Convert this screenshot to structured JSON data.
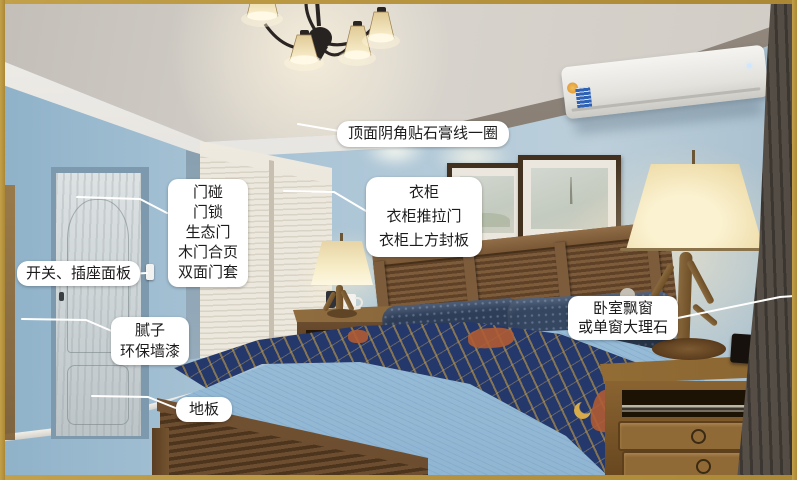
{
  "annotations": [
    {
      "id": "ceiling",
      "text": "顶面阴角贴石膏线一圈"
    },
    {
      "id": "door",
      "text": "门碰\n门锁\n生态门\n木门合页\n双面门套"
    },
    {
      "id": "switch",
      "text": "开关、插座面板"
    },
    {
      "id": "wall",
      "text": "腻子\n环保墙漆"
    },
    {
      "id": "floor",
      "text": "地板"
    },
    {
      "id": "wardrobe",
      "text": "衣柜\n衣柜推拉门\n衣柜上方封板"
    },
    {
      "id": "window",
      "text": "卧室飘窗\n或单窗大理石"
    }
  ],
  "scene": {
    "description": "bedroom photo with renovation callout labels",
    "objects": [
      "ceiling plaster cornice",
      "chandelier",
      "air conditioner",
      "wardrobe sliding doors",
      "entry door",
      "light switch",
      "picture frames",
      "bed with headboard",
      "pillows",
      "blue quilt",
      "navy-gold throw blanket",
      "nightstands",
      "antler table lamps",
      "dresser",
      "curtain",
      "wood floor"
    ],
    "colors": {
      "frame_gold": "#b5923c",
      "wall_blue": "#a5c1d4",
      "ceiling_gray": "#d5d0c9",
      "floor_brown": "#4a382b",
      "headboard_wood": "#6f5034",
      "quilt_blue": "#9dc1db",
      "throw_navy": "#24386b",
      "throw_gold": "#d3a545",
      "lamp_glow": "#f6ecc8",
      "label_bg": "#ffffff",
      "label_text": "#1c1c1c"
    }
  }
}
